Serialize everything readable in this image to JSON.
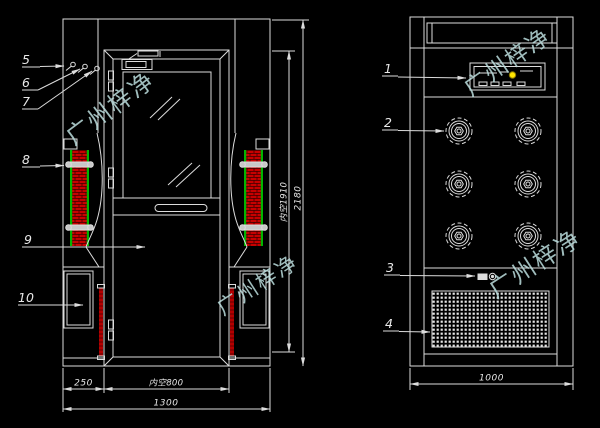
{
  "title": "air-shower-technical-drawing",
  "watermark": {
    "text": "广州梓净",
    "color": "#bcdede"
  },
  "colors": {
    "background": "#000000",
    "line": "#dcdcdc",
    "filter_hatch": "#c80000",
    "filter_edge": "#00b400",
    "indicator_button": "#ffe400"
  },
  "front_view": {
    "callouts": {
      "c5": "5",
      "c6": "6",
      "c7": "7",
      "c8": "8",
      "c9": "9",
      "c10": "10"
    },
    "dims": {
      "inner_height": "内空1910",
      "overall_height": "2180",
      "side_width": "250",
      "inner_width": "内空800",
      "overall_width": "1300"
    }
  },
  "side_view": {
    "callouts": {
      "c1": "1",
      "c2": "2",
      "c3": "3",
      "c4": "4"
    },
    "dims": {
      "overall_depth": "1000"
    }
  }
}
